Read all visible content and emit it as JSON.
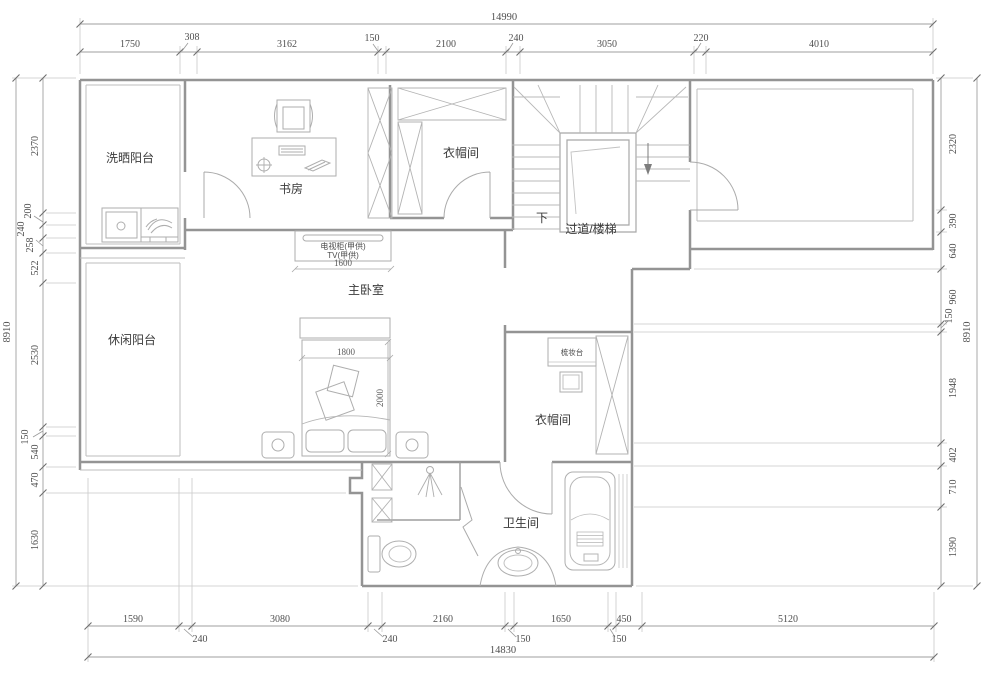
{
  "plan": {
    "rooms": {
      "laundry_balcony": "洗晒阳台",
      "study": "书房",
      "cloakroom_top": "衣帽间",
      "corridor_stairs": "过道/楼梯",
      "stairs_down": "下",
      "master_bedroom": "主卧室",
      "leisure_balcony": "休闲阳台",
      "dressing_table": "梳妆台",
      "cloakroom_right": "衣帽间",
      "bathroom": "卫生间"
    },
    "furniture": {
      "tv_cabinet": "电视柜(甲供)",
      "tv": "TV(甲供)",
      "tv_width": "1600",
      "bed_width": "1800",
      "bed_length": "2000"
    },
    "dimensions": {
      "top": {
        "total": "14990",
        "segments": [
          "1750",
          "308",
          "3162",
          "150",
          "2100",
          "240",
          "3050",
          "220",
          "4010"
        ]
      },
      "bottom": {
        "total": "14830",
        "segments": [
          "1590",
          "240",
          "3080",
          "240",
          "2160",
          "150",
          "1650",
          "150",
          "450",
          "5120"
        ]
      },
      "left": {
        "total": "8910",
        "segments": [
          "2370",
          "200",
          "240",
          "258",
          "522",
          "2530",
          "150",
          "540",
          "470",
          "1630"
        ]
      },
      "right": {
        "total": "8910",
        "segments": [
          "2320",
          "390",
          "640",
          "960",
          "150",
          "1948",
          "402",
          "710",
          "1390"
        ]
      }
    },
    "colors": {
      "wall": "#949494",
      "light_line": "#bdbdbd",
      "furniture": "#aeaeae",
      "dim_line": "#9f9f9f",
      "text": "#4f4f4f"
    }
  }
}
